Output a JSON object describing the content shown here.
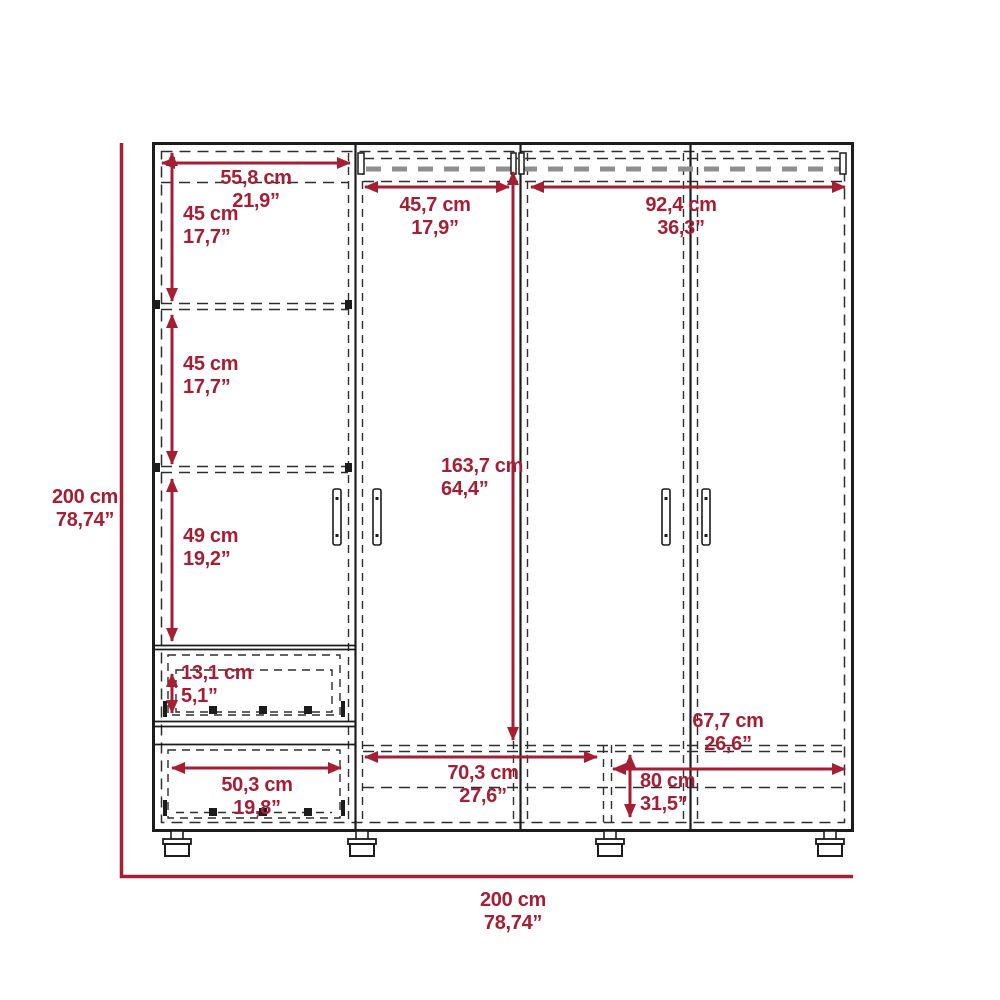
{
  "diagram": "wardrobe-dimension-drawing",
  "colors": {
    "accent": "#a51e34",
    "line": "#1c1c1c",
    "gray_dash": "#8f8f8f",
    "background": "#ffffff"
  },
  "dimensions": {
    "top_shelf_width": {
      "cm": "55,8 cm",
      "inch": "21,9”"
    },
    "section1_height": {
      "cm": "45 cm",
      "inch": "17,7”"
    },
    "section2_height": {
      "cm": "45 cm",
      "inch": "17,7”"
    },
    "section3_height": {
      "cm": "49 cm",
      "inch": "19,2”"
    },
    "drawer_height": {
      "cm": "13,1 cm",
      "inch": "5,1”"
    },
    "drawer_width": {
      "cm": "50,3 cm",
      "inch": "19,8”"
    },
    "rod_mid_width": {
      "cm": "45,7 cm",
      "inch": "17,9”"
    },
    "rod_right_width": {
      "cm": "92,4 cm",
      "inch": "36,3”"
    },
    "door_height": {
      "cm": "163,7 cm",
      "inch": "64,4”"
    },
    "bottom_mid_width": {
      "cm": "70,3 cm",
      "inch": "27,6”"
    },
    "bottom_right_width": {
      "cm": "67,7 cm",
      "inch": "26,6”"
    },
    "bottom_right_depth": {
      "cm": "80 cm",
      "inch": "31,5”"
    },
    "overall_height": {
      "cm": "200 cm",
      "inch": "78,74”"
    },
    "overall_width": {
      "cm": "200 cm",
      "inch": "78,74”"
    }
  }
}
